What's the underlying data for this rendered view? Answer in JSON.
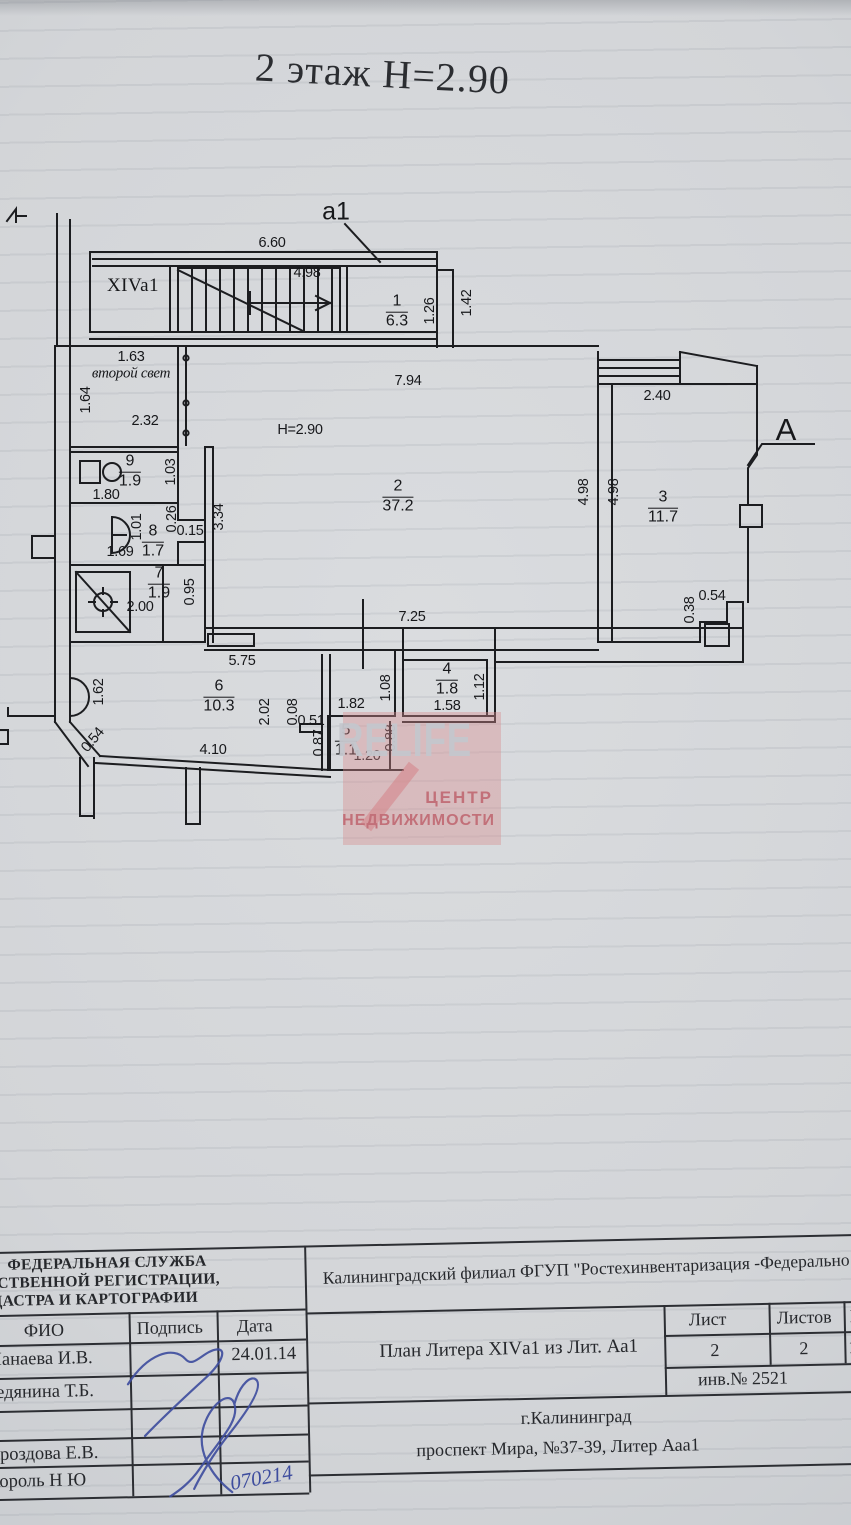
{
  "page": {
    "title": "2 этаж  Н=2.90"
  },
  "plan": {
    "labels": [
      {
        "text": "6.60",
        "x": 272,
        "y": 243
      },
      {
        "text": "а1",
        "x": 336,
        "y": 212,
        "cls": "callout"
      },
      {
        "text": "XIVa1",
        "x": 133,
        "y": 286,
        "cls": "name"
      },
      {
        "text": "4.98",
        "x": 307,
        "y": 273
      },
      {
        "text": "1.26",
        "x": 430,
        "y": 311,
        "rot": -90
      },
      {
        "text": "1.42",
        "x": 467,
        "y": 303,
        "rot": -90
      },
      {
        "text": "7.94",
        "x": 408,
        "y": 381
      },
      {
        "text": "1.63",
        "x": 131,
        "y": 357
      },
      {
        "text": "второй свет",
        "x": 131,
        "y": 374,
        "cls": "script"
      },
      {
        "text": "1.64",
        "x": 86,
        "y": 400,
        "rot": -90
      },
      {
        "text": "2.32",
        "x": 145,
        "y": 421
      },
      {
        "text": "H=2.90",
        "x": 300,
        "y": 430
      },
      {
        "text": "2.40",
        "x": 657,
        "y": 396
      },
      {
        "text": "А",
        "x": 786,
        "y": 430,
        "cls": "callout-lg"
      },
      {
        "text": "4.98",
        "x": 584,
        "y": 492,
        "rot": -90
      },
      {
        "text": "4.98",
        "x": 614,
        "y": 492,
        "rot": -90
      },
      {
        "text": "1.80",
        "x": 106,
        "y": 495
      },
      {
        "text": "1.03",
        "x": 171,
        "y": 472,
        "rot": -90
      },
      {
        "text": "1.01",
        "x": 137,
        "y": 527,
        "rot": -90
      },
      {
        "text": "0.26",
        "x": 172,
        "y": 519,
        "rot": -90
      },
      {
        "text": "0.15",
        "x": 190,
        "y": 531
      },
      {
        "text": "1.69",
        "x": 120,
        "y": 552
      },
      {
        "text": "3.34",
        "x": 219,
        "y": 517,
        "rot": -90
      },
      {
        "text": "0.95",
        "x": 190,
        "y": 592,
        "rot": -90
      },
      {
        "text": "2.00",
        "x": 140,
        "y": 607
      },
      {
        "text": "0.54",
        "x": 712,
        "y": 596
      },
      {
        "text": "0.38",
        "x": 690,
        "y": 610,
        "rot": -90
      },
      {
        "text": "7.25",
        "x": 412,
        "y": 617
      },
      {
        "text": "5.75",
        "x": 242,
        "y": 661
      },
      {
        "text": "1.62",
        "x": 99,
        "y": 692,
        "rot": -90
      },
      {
        "text": "0.54",
        "x": 93,
        "y": 740,
        "rot": -50
      },
      {
        "text": "4.10",
        "x": 213,
        "y": 750
      },
      {
        "text": "2.02",
        "x": 265,
        "y": 712,
        "rot": -90
      },
      {
        "text": "0.08",
        "x": 293,
        "y": 712,
        "rot": -90
      },
      {
        "text": "0.51",
        "x": 311,
        "y": 721
      },
      {
        "text": "1.82",
        "x": 351,
        "y": 704
      },
      {
        "text": "1.08",
        "x": 386,
        "y": 688,
        "rot": -90
      },
      {
        "text": "1.20",
        "x": 367,
        "y": 756
      },
      {
        "text": "0.88",
        "x": 391,
        "y": 738,
        "rot": -90
      },
      {
        "text": "0.87",
        "x": 319,
        "y": 743,
        "rot": -90
      },
      {
        "text": "1.58",
        "x": 447,
        "y": 706
      },
      {
        "text": "1.12",
        "x": 480,
        "y": 687,
        "rot": -90
      }
    ],
    "rooms": [
      {
        "num": "1",
        "area": "6.3",
        "x": 397,
        "y": 312
      },
      {
        "num": "2",
        "area": "37.2",
        "x": 398,
        "y": 497
      },
      {
        "num": "3",
        "area": "11.7",
        "x": 663,
        "y": 508
      },
      {
        "num": "4",
        "area": "1.8",
        "x": 447,
        "y": 680
      },
      {
        "num": "5",
        "area": "1.1",
        "x": 346,
        "y": 741
      },
      {
        "num": "6",
        "area": "10.3",
        "x": 219,
        "y": 697
      },
      {
        "num": "7",
        "area": "1.9",
        "x": 159,
        "y": 584
      },
      {
        "num": "8",
        "area": "1.7",
        "x": 153,
        "y": 542
      },
      {
        "num": "9",
        "area": "1.9",
        "x": 130,
        "y": 472
      }
    ]
  },
  "watermark": {
    "big": "RELIFE",
    "line2": "ЦЕНТР",
    "line3": "НЕДВИЖИМОСТИ"
  },
  "title_block": {
    "agency_lines": [
      "ФЕДЕРАЛЬНАЯ СЛУЖБА",
      "АРСТВЕННОЙ РЕГИСТРАЦИИ,",
      "АДАСТРА И КАРТОГРАФИИ"
    ],
    "org": "Калининградский филиал ФГУП \"Ростехинвентаризация -Федерально",
    "table": {
      "headers": [
        "ФИО",
        "Подпись",
        "Дата"
      ],
      "rows": [
        {
          "name": "Манаева И.В.",
          "date": "24.01.14"
        },
        {
          "name": "Редянина Т.Б.",
          "date": ""
        },
        {
          "name": "",
          "date": ""
        },
        {
          "name": "Дроздова Е.В.",
          "date": ""
        },
        {
          "name": "Король Н Ю",
          "date": ""
        }
      ],
      "handwritten_date": "070214"
    },
    "doc_title": "План Литера XIVа1 из Лит. Аа1",
    "sheet": {
      "list_label": "Лист",
      "lists_label": "Листов",
      "scale_label": "М",
      "list_value": "2",
      "lists_value": "2",
      "scale_value": "1:",
      "inventory": "инв.№  2521"
    },
    "address_city": "г.Калининград",
    "address_street": "проспект Мира,  №37-39, Литер Ааа1"
  }
}
